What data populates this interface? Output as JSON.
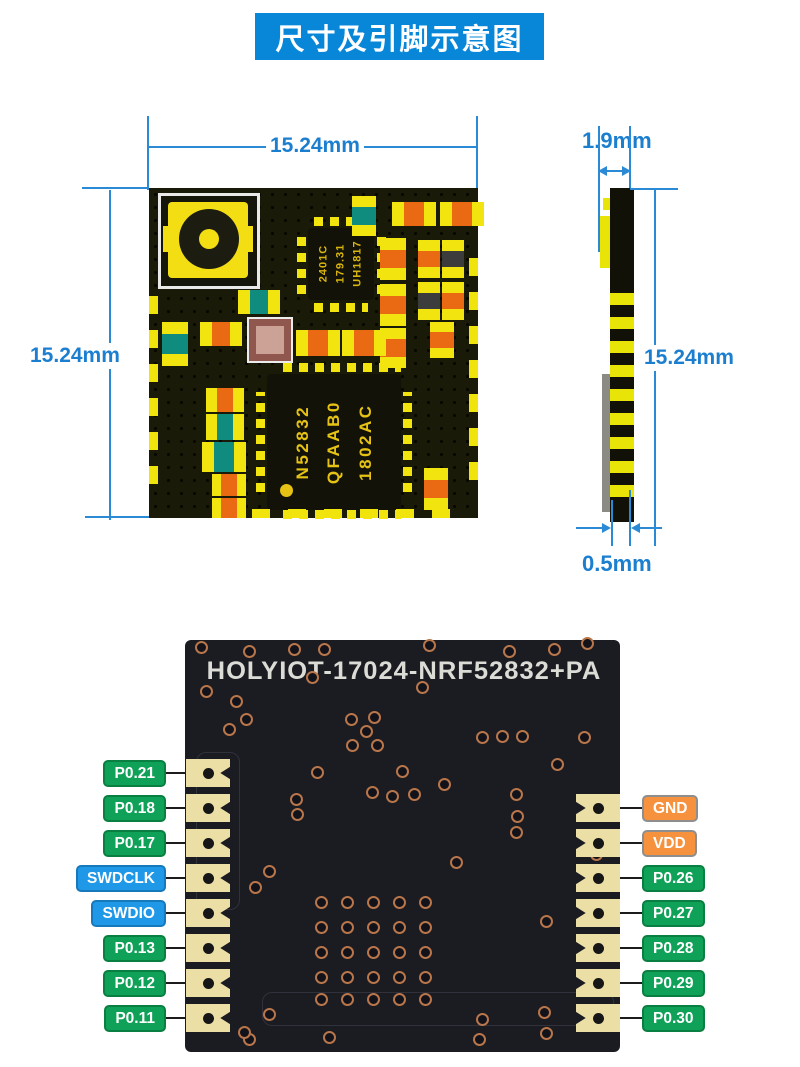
{
  "header": {
    "title": "尺寸及引脚示意图"
  },
  "top_view": {
    "width_dim": "15.24mm",
    "height_dim": "15.24mm",
    "shield_chip": {
      "line1": "2401C",
      "line2": "179.31",
      "line3": "UH1817"
    },
    "main_chip": {
      "line1": "N52832",
      "line2": "QFAAB0",
      "line3": "1802AC"
    }
  },
  "side_view": {
    "thickness_dim": "1.9mm",
    "height_dim": "15.24mm",
    "pad_dim": "0.5mm"
  },
  "bottom_view": {
    "silkscreen": "HOLYIOT-17024-NRF52832+PA",
    "pins_left": [
      {
        "label": "P0.21",
        "type": "gpio"
      },
      {
        "label": "P0.18",
        "type": "gpio"
      },
      {
        "label": "P0.17",
        "type": "gpio"
      },
      {
        "label": "SWDCLK",
        "type": "debug"
      },
      {
        "label": "SWDIO",
        "type": "debug"
      },
      {
        "label": "P0.13",
        "type": "gpio"
      },
      {
        "label": "P0.12",
        "type": "gpio"
      },
      {
        "label": "P0.11",
        "type": "gpio"
      }
    ],
    "pins_right": [
      {
        "label": "GND",
        "type": "power"
      },
      {
        "label": "VDD",
        "type": "power"
      },
      {
        "label": "P0.26",
        "type": "gpio"
      },
      {
        "label": "P0.27",
        "type": "gpio"
      },
      {
        "label": "P0.28",
        "type": "gpio"
      },
      {
        "label": "P0.29",
        "type": "gpio"
      },
      {
        "label": "P0.30",
        "type": "gpio"
      }
    ]
  },
  "colors": {
    "title_bg": "#0887d9",
    "dimension": "#1c7ecf",
    "gpio_bg": "#10a158",
    "gpio_border": "#0a7f42",
    "debug_bg": "#2098e8",
    "debug_border": "#1679bb",
    "power_bg": "#f6923e",
    "power_border": "#8e8e8e"
  }
}
